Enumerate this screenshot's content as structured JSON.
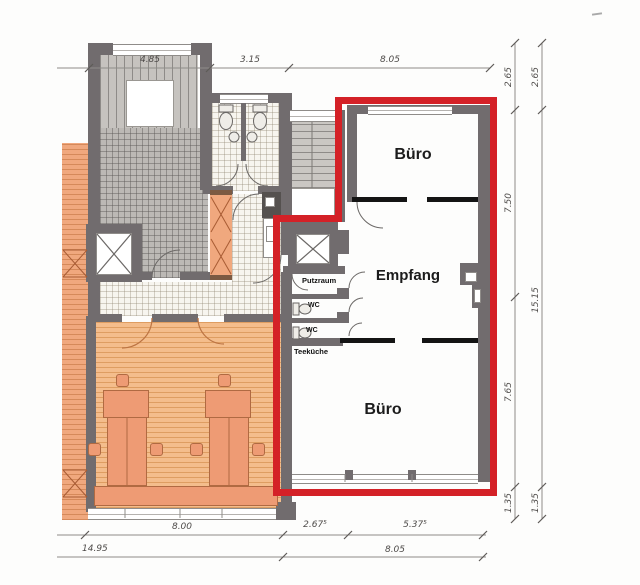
{
  "plan_title": "floor-plan-with-red-highlighted-unit",
  "rooms": {
    "buero_top": "Büro",
    "empfang": "Empfang",
    "buero_bottom": "Büro",
    "putzraum": "Putzraum",
    "wc_upper": "WC",
    "wc_lower": "WC",
    "teekueche": "Teeküche"
  },
  "dimensions": {
    "top": [
      "4.85",
      "3.15",
      "8.05"
    ],
    "right_inner": [
      "2.65",
      "7.50",
      "7.65",
      "1.35"
    ],
    "right_outer": [
      "2.65",
      "15.15",
      "1.35"
    ],
    "bottom_upper": [
      "8.00",
      "2.67⁵",
      "5.37⁵"
    ],
    "bottom_lower": [
      "14.95",
      "8.05"
    ]
  },
  "colors": {
    "highlight_red": "#d42127",
    "wall_gray": "#716c6e",
    "wood_floor_orange": "#f4bd8c",
    "furniture_salmon": "#ee9b74"
  }
}
